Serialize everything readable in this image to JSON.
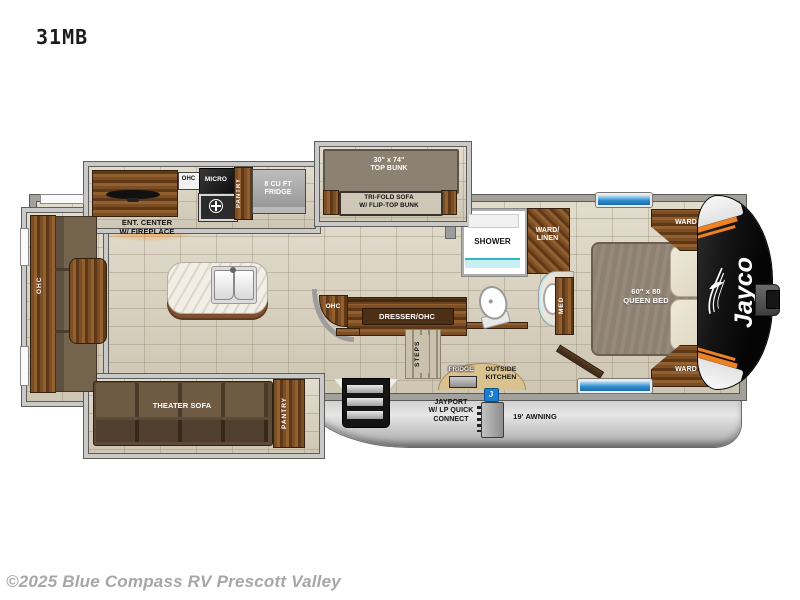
{
  "header": {
    "model": "31MB"
  },
  "footer": {
    "copyright": "©2025 Blue Compass RV Prescott Valley"
  },
  "exterior": {
    "brand": "Jayco",
    "awning": "19' AWNING",
    "jayport": "JAYPORT\nW/ LP QUICK\nCONNECT",
    "j_badge": "J",
    "outside_kitchen": "OUTSIDE\nKITCHEN",
    "outside_fridge": "FRIDGE"
  },
  "kitchen": {
    "ohc_box": "OHC",
    "micro": "MICRO",
    "pantry": "PANTRY",
    "fridge": "8 CU FT\nFRIDGE",
    "ent_center": "ENT. CENTER\nW/ FIREPLACE",
    "ohc_curve": "OHC"
  },
  "bunk": {
    "top_bunk": "30\" x 74\"\nTOP BUNK",
    "sofa": "TRI-FOLD SOFA\nW/ FLIP-TOP BUNK"
  },
  "bath": {
    "shower": "SHOWER",
    "ward_linen": "WARD/\nLINEN",
    "med": "MED"
  },
  "bedroom": {
    "bed": "60\" x 80\nQUEEN BED",
    "ward_top": "WARD",
    "ward_bottom": "WARD",
    "dresser": "DRESSER/OHC",
    "steps": "STEPS"
  },
  "living": {
    "ohc_slide": "OHC",
    "theater_sofa": "THEATER SOFA",
    "pantry": "PANTRY"
  },
  "colors": {
    "floor": "#d9d1bd",
    "wall": "#a3a19c",
    "wall_edge": "#5c5a55",
    "slide_border": "#c9c9c9",
    "wood_light": "#93602f",
    "wood_mid": "#7c4e26",
    "wood_dark": "#5f3818",
    "teal": "#2fb7c6",
    "window_blue": "#2e8fd0",
    "orange": "#f08122",
    "cap_black": "#141414",
    "glow": "#ffa620",
    "badge_blue": "#1b7ed2"
  }
}
